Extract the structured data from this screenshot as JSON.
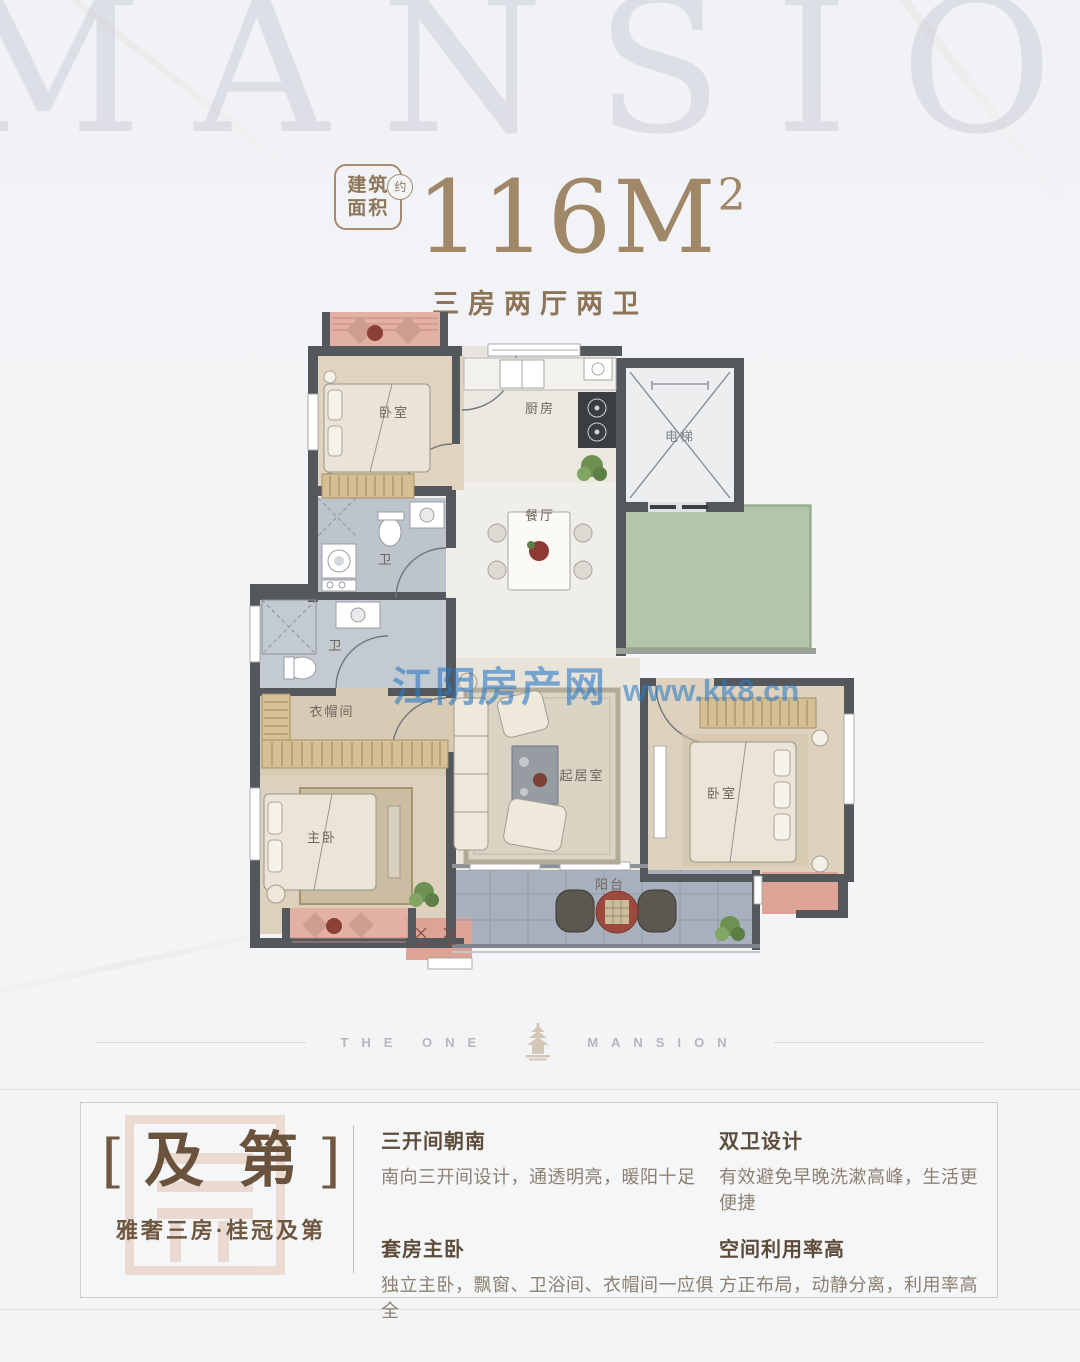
{
  "background_watermark": "MANSION",
  "header": {
    "badge": {
      "line1": "建筑",
      "line2": "面积",
      "approx": "约"
    },
    "area": {
      "value": "116M",
      "superscript": "2"
    },
    "subtitle": "三房两厅两卫"
  },
  "floorplan": {
    "rooms": {
      "bedroom_top": "卧室",
      "kitchen": "厨房",
      "elevator": "电梯",
      "dining": "餐厅",
      "bath_upper": "卫",
      "bath_lower": "卫",
      "closet": "衣帽间",
      "master_bedroom": "主卧",
      "living": "起居室",
      "bedroom_right": "卧室",
      "balcony": "阳台"
    },
    "watermark": {
      "site": "江阴房产网",
      "url": "www.kk8.cn"
    }
  },
  "brand": {
    "left": "THE ONE",
    "right": "MANSION"
  },
  "info": {
    "bracket_open": "[",
    "name": "及第",
    "bracket_close": "]",
    "tagline": "雅奢三房·桂冠及第",
    "features": [
      {
        "title": "三开间朝南",
        "desc": "南向三开间设计，通透明亮，暖阳十足"
      },
      {
        "title": "双卫设计",
        "desc": "有效避免早晚洗漱高峰，生活更便捷"
      },
      {
        "title": "套房主卧",
        "desc": "独立主卧，飘窗、卫浴间、衣帽间一应俱全"
      },
      {
        "title": "空间利用率高",
        "desc": "方正布局，动静分离，利用率高"
      }
    ]
  },
  "colors": {
    "accent_brown": "#9f8768",
    "dark_brown": "#6b523c",
    "wall": "#54585d",
    "balcony_tile": "#a7b1bd",
    "green_area": "#b3c6aa",
    "pink_accent": "#dda394",
    "watermark_blue": "#2a7ac6"
  }
}
